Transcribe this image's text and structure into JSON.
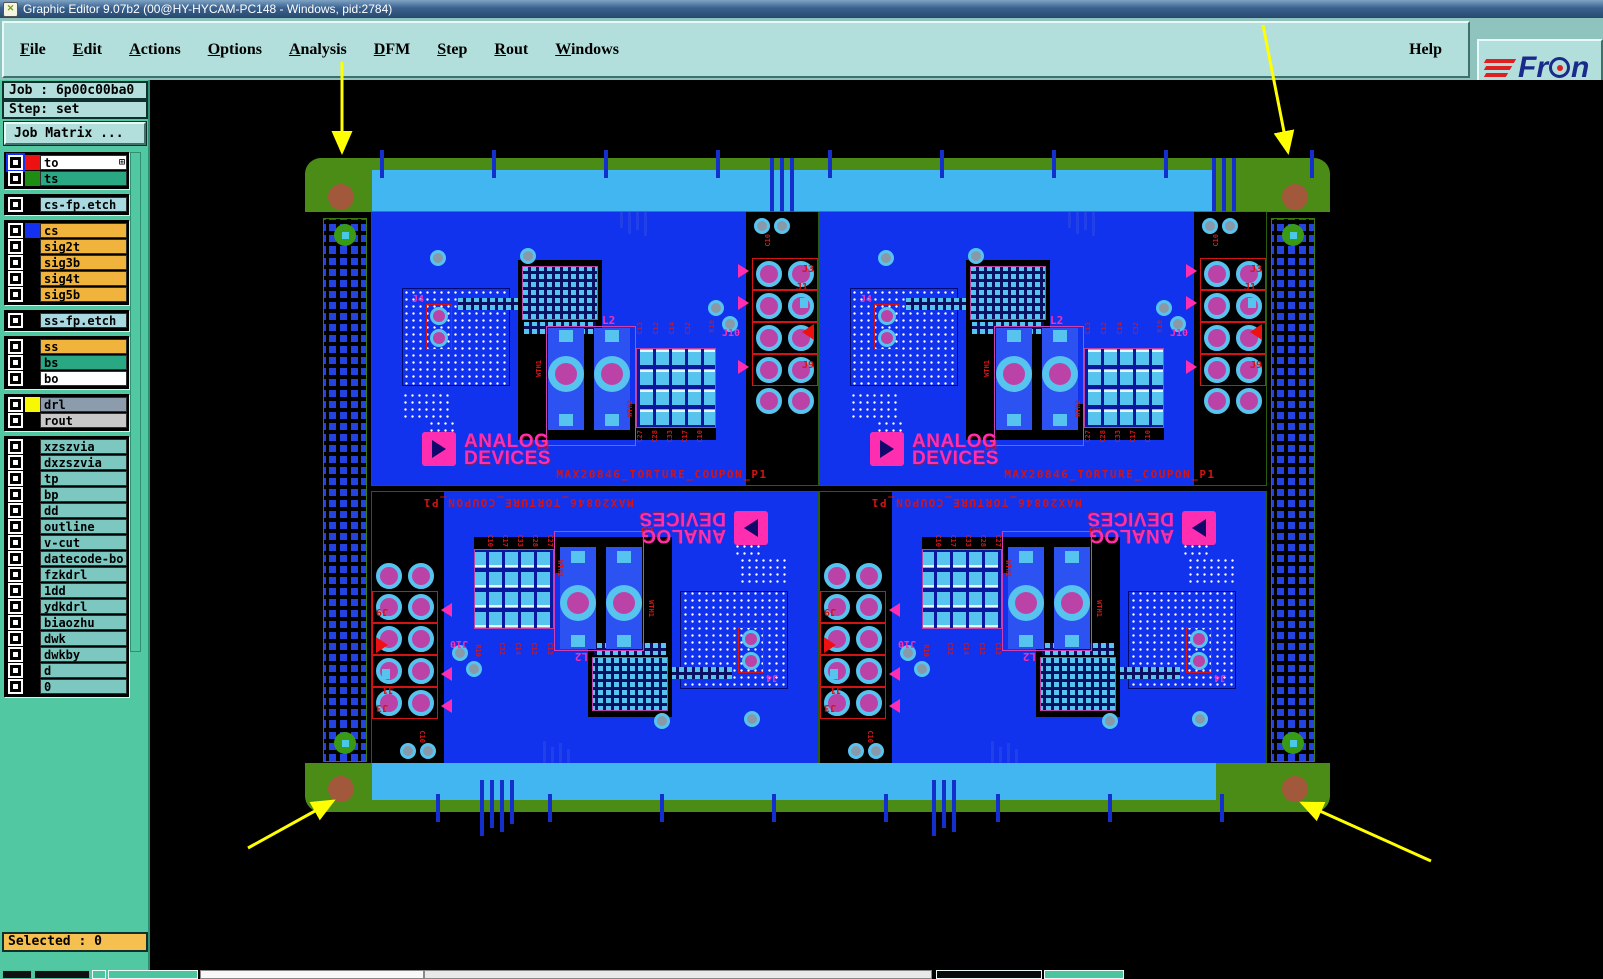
{
  "window": {
    "title": "Graphic Editor 9.07b2 (00@HY-HYCAM-PC148 - Windows, pid:2784)",
    "icon_glyph": "✕"
  },
  "menu": {
    "items": [
      {
        "label": "File",
        "cls": "u"
      },
      {
        "label": "Edit",
        "cls": "u"
      },
      {
        "label": "Actions",
        "cls": "u"
      },
      {
        "label": "Options",
        "cls": "u"
      },
      {
        "label": "Analysis",
        "cls": "u"
      },
      {
        "label": "DFM",
        "cls": "u"
      },
      {
        "label": "Step",
        "cls": "u"
      },
      {
        "label": "Rout",
        "cls": "u"
      },
      {
        "label": "Windows",
        "cls": "u"
      }
    ],
    "help_label": "Help"
  },
  "logo": {
    "pre": "Fr",
    "post": "n"
  },
  "sidebar": {
    "job_label": "Job : 6p00c00ba0",
    "step_label": "Step: set",
    "job_matrix_label": "Job Matrix ...",
    "selected_label": "Selected : 0",
    "layer_groups": [
      [
        {
          "name": "to",
          "bg": "#ffffff",
          "swatch": "#ee1111",
          "cls": "active"
        },
        {
          "name": "ts",
          "bg": "#2aa884",
          "swatch": "#1e8c14"
        }
      ],
      [
        {
          "name": "cs-fp.etch",
          "bg": "#a8d8e0",
          "swatch": "#000000"
        }
      ],
      [
        {
          "name": "cs",
          "bg": "#f0b43c",
          "swatch": "#1430f0"
        },
        {
          "name": "sig2t",
          "bg": "#f0b43c",
          "swatch": "#000000"
        },
        {
          "name": "sig3b",
          "bg": "#f0b43c",
          "swatch": "#000000"
        },
        {
          "name": "sig4t",
          "bg": "#f0b43c",
          "swatch": "#000000"
        },
        {
          "name": "sig5b",
          "bg": "#f0b43c",
          "swatch": "#000000"
        }
      ],
      [
        {
          "name": "ss-fp.etch",
          "bg": "#a8d8e0",
          "swatch": "#000000"
        }
      ],
      [
        {
          "name": "ss",
          "bg": "#f0b43c",
          "swatch": "#000000"
        },
        {
          "name": "bs",
          "bg": "#2aa884",
          "swatch": "#000000"
        },
        {
          "name": "bo",
          "bg": "#ffffff",
          "swatch": "#000000"
        }
      ],
      [
        {
          "name": "drl",
          "bg": "#8c9cac",
          "swatch": "#f8f800"
        },
        {
          "name": "rout",
          "bg": "#c8c8c8",
          "swatch": "#000000"
        }
      ],
      [
        {
          "name": "xzszvia",
          "bg": "#7cc8c0",
          "swatch": "#000000"
        },
        {
          "name": "dxzszvia",
          "bg": "#7cc8c0",
          "swatch": "#000000"
        },
        {
          "name": "tp",
          "bg": "#7cc8c0",
          "swatch": "#000000"
        },
        {
          "name": "bp",
          "bg": "#7cc8c0",
          "swatch": "#000000"
        },
        {
          "name": "dd",
          "bg": "#7cc8c0",
          "swatch": "#000000"
        },
        {
          "name": "outline",
          "bg": "#7cc8c0",
          "swatch": "#000000"
        },
        {
          "name": "v-cut",
          "bg": "#7cc8c0",
          "swatch": "#000000"
        },
        {
          "name": "datecode-bo",
          "bg": "#7cc8c0",
          "swatch": "#000000"
        },
        {
          "name": "fzkdrl",
          "bg": "#7cc8c0",
          "swatch": "#000000"
        },
        {
          "name": "1dd",
          "bg": "#7cc8c0",
          "swatch": "#000000"
        },
        {
          "name": "ydkdrl",
          "bg": "#7cc8c0",
          "swatch": "#000000"
        },
        {
          "name": "biaozhu",
          "bg": "#7cc8c0",
          "swatch": "#000000"
        },
        {
          "name": "dwk",
          "bg": "#7cc8c0",
          "swatch": "#000000"
        },
        {
          "name": "dwkby",
          "bg": "#7cc8c0",
          "swatch": "#000000"
        },
        {
          "name": "d",
          "bg": "#7cc8c0",
          "swatch": "#000000"
        },
        {
          "name": "0",
          "bg": "#7cc8c0",
          "swatch": "#000000"
        }
      ]
    ]
  },
  "board": {
    "title": "MAX20846_TORTURE_COUPON_P1",
    "logo_line1": "ANALOG",
    "logo_line2": "DEVICES",
    "labels": {
      "j4": "J4",
      "l2": "L2",
      "l3": "L3",
      "j3": "J3",
      "j1": "J1",
      "j10": "J10",
      "j9": "J9",
      "wth1": "WTH1",
      "wth2": "WTH2",
      "c10": "C10",
      "r10": "R10"
    },
    "cap_top": [
      "C13",
      "C12",
      "C14",
      "C32"
    ],
    "cap_bottom": [
      "C27",
      "C28",
      "C33",
      "C17",
      "C10"
    ]
  },
  "colors": {
    "menu_teal": "#b2dedb",
    "sidebar_teal": "#52c8a2",
    "selected_orange": "#f5c050",
    "layer_orange": "#f0b43c",
    "layer_lightblue": "#a8d8e0",
    "layer_lightteal": "#7cc8c0",
    "rail_green": "#4a8c16",
    "panel_cyan": "#41b6f1",
    "board_blue": "#1133ee",
    "pad_cyan": "#57c3ef",
    "pad_magenta": "#bb43a8",
    "silk_red": "#d41414",
    "logo_magenta": "#ff2eb0",
    "fiducial_brown": "#a2583a",
    "via_blue": "#2443e0",
    "arrow_yellow": "#ffff00"
  }
}
